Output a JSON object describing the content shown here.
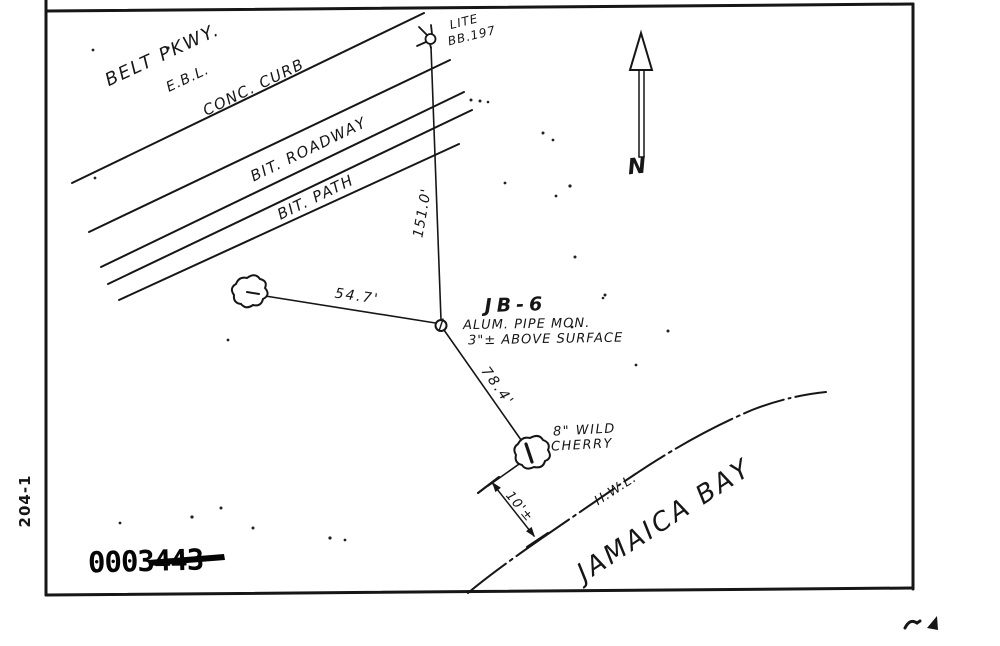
{
  "document": {
    "type": "scanned survey station sketch",
    "ink_color": "#161616",
    "paper_color": "#ffffff"
  },
  "labels": {
    "belt_pkwy": "BELT PKWY.",
    "ebl": "E.B.L.",
    "conc_curb": "CONC. CURB",
    "bit_roadway": "BIT. ROADWAY",
    "bit_path": "BIT. PATH",
    "lite_line1": "LITE",
    "lite_line2": "BB.197",
    "north_letter": "N",
    "dist_lite_to_mon": "151.0'",
    "dist_tree_to_mon": "54.7'",
    "dist_mon_to_cherry": "78.4'",
    "dist_cherry_to_hwl": "10'±",
    "station_id": "JB-6",
    "mon_desc_line1": "ALUM. PIPE MON.",
    "mon_desc_line2": "3\"± ABOVE SURFACE",
    "cherry_line1": "8\" WILD",
    "cherry_line2": "CHERRY",
    "hwl": "H.W.L.",
    "bay_name": "JAMAICA BAY",
    "margin_code": "204-1",
    "stamp_number": "0003443"
  },
  "icons": {
    "north_arrow": "north-arrow",
    "light_pole": "street-light-symbol",
    "monument": "pipe-monument-symbol",
    "tree": "tree-canopy-symbol",
    "cherry_tree": "wild-cherry-tree-symbol"
  }
}
